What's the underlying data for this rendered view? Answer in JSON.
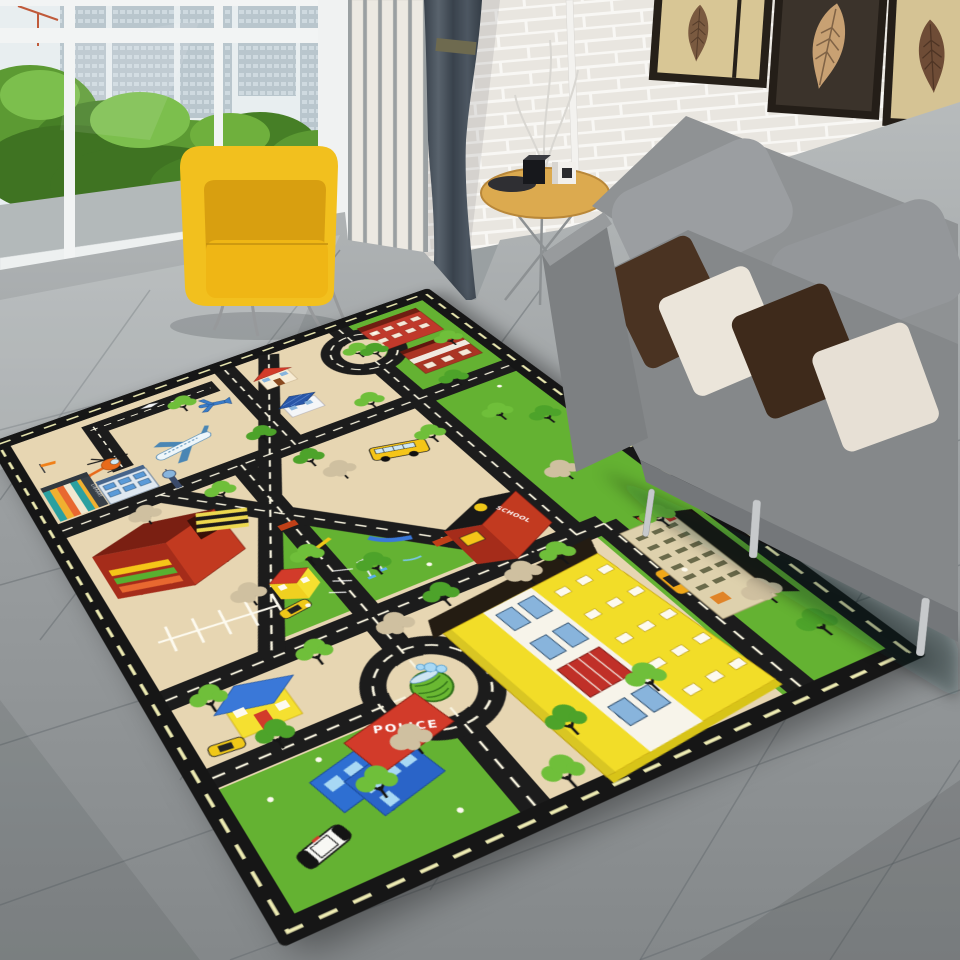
{
  "meta": {
    "title": "Kids city road play rug in a living room",
    "type": "product photo"
  },
  "room": {
    "window": {
      "view": "high-rise towers and green trees",
      "frame_color": "#f2f4f4"
    },
    "slatted_screen": {
      "color": "#ece9e2"
    },
    "curtain": {
      "color": "#46505a"
    },
    "brick_wall": {
      "color": "#e9e6e0"
    },
    "art_frames": {
      "count": 3,
      "style": "dried leaf prints",
      "frame_color": "#241e18"
    },
    "armchair": {
      "color": "#f2c01e"
    },
    "sofa": {
      "color": "#8b8e90",
      "pillow_colors": [
        "#4a3322",
        "#ebe5da",
        "#3e2a1b",
        "#e7e0d5"
      ]
    },
    "side_table": {
      "top_color": "#dcaa4f",
      "items": [
        "black cube",
        "white cube",
        "dark tray"
      ]
    },
    "floor": {
      "type": "large gray tiles",
      "color": "#9aa0a2"
    }
  },
  "rug": {
    "labels": {
      "police": "POLICE",
      "library": "LIBRARY",
      "school": "SCHOOL"
    },
    "palette": {
      "border": "#161616",
      "road": "#1c1c1c",
      "road_dash": "#f7f3df",
      "border_dash": "#efedb4",
      "ground": "#e7d6b2",
      "grass": "#64b232",
      "tree_green": "#6fbf3a",
      "tree_beige": "#cfc0a0"
    },
    "features": [
      "airport runway",
      "passenger plane",
      "helicopter",
      "jet",
      "windsock",
      "library",
      "market",
      "parking lot",
      "crosswalk",
      "park playground",
      "seesaw",
      "slide",
      "swings",
      "school bus",
      "school",
      "fountain roundabout",
      "top roundabout",
      "police station",
      "police car",
      "taxi",
      "yellow cars",
      "yellow apartment building",
      "tan building",
      "houses",
      "trees"
    ]
  }
}
